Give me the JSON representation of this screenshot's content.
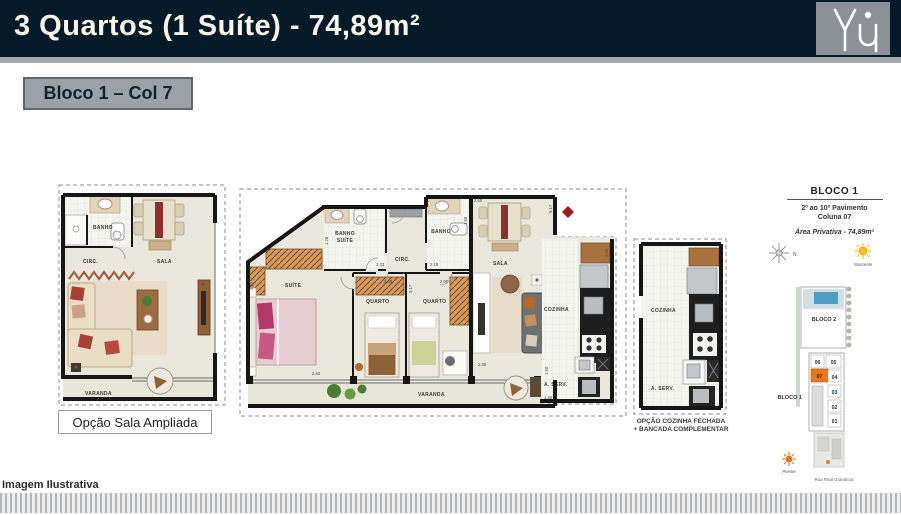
{
  "header": {
    "title": "3 Quartos (1 Suíte) - 74,89m²",
    "logo_name": "You"
  },
  "selector": {
    "label": "Bloco 1 – Col 7"
  },
  "plans": {
    "left": {
      "caption": "Opção Sala Ampliada",
      "rooms": {
        "banho": "BANHO",
        "circ": "CIRC.",
        "sala": "SALA",
        "varanda": "VARANDA"
      }
    },
    "main": {
      "rooms": {
        "banho_suite_l1": "BANHO",
        "banho_suite_l2": "SUÍTE",
        "banho": "BANHO",
        "circ": "CIRC.",
        "suite": "SUÍTE",
        "quarto1": "QUARTO",
        "quarto2": "QUARTO",
        "sala": "SALA",
        "varanda": "VARANDA",
        "cozinha": "COZINHA",
        "area_servico": "A. SERV."
      },
      "dims": {
        "banho_suite_w": "2.33",
        "banho_w": "2.18",
        "banho_suite_h": "1.28",
        "banho_h": "1.58",
        "sala_top": "2.50",
        "sala_right": "5.17",
        "quarto1_w": "2.38",
        "quarto2_w": "2.00",
        "quarto2_h": "3.17",
        "suite_h": "4.07",
        "suite_w": "2.50",
        "sala_bottom": "2.30",
        "cozinha_h": "4.00",
        "aserv_w": "1.30",
        "varanda_r": "1.50"
      }
    },
    "kitchen_option": {
      "rooms": {
        "cozinha": "COZINHA",
        "area_servico": "A. SERV."
      },
      "caption_line1": "OPÇÃO COZINHA FECHADA",
      "caption_line2": "+ BANCADA COMPLEMENTAR"
    }
  },
  "keyplan": {
    "title": "BLOCO 1",
    "floors": "2º ao 10º Pavimento",
    "column": "Coluna 07",
    "area": "Área Privativa - 74,89m²",
    "compass_label": "N",
    "nascente": "Nascente",
    "poente": "Poente",
    "bloco2_label": "BLOCO 2",
    "bloco1_label": "BLOCO 1",
    "units": [
      "06",
      "05",
      "07",
      "04",
      "03",
      "02",
      "01"
    ],
    "highlighted_unit": "07",
    "highlight_color": "#E87722",
    "street": "Rua Real Grandeza"
  },
  "footer": {
    "note": "Imagem Ilustrativa"
  }
}
